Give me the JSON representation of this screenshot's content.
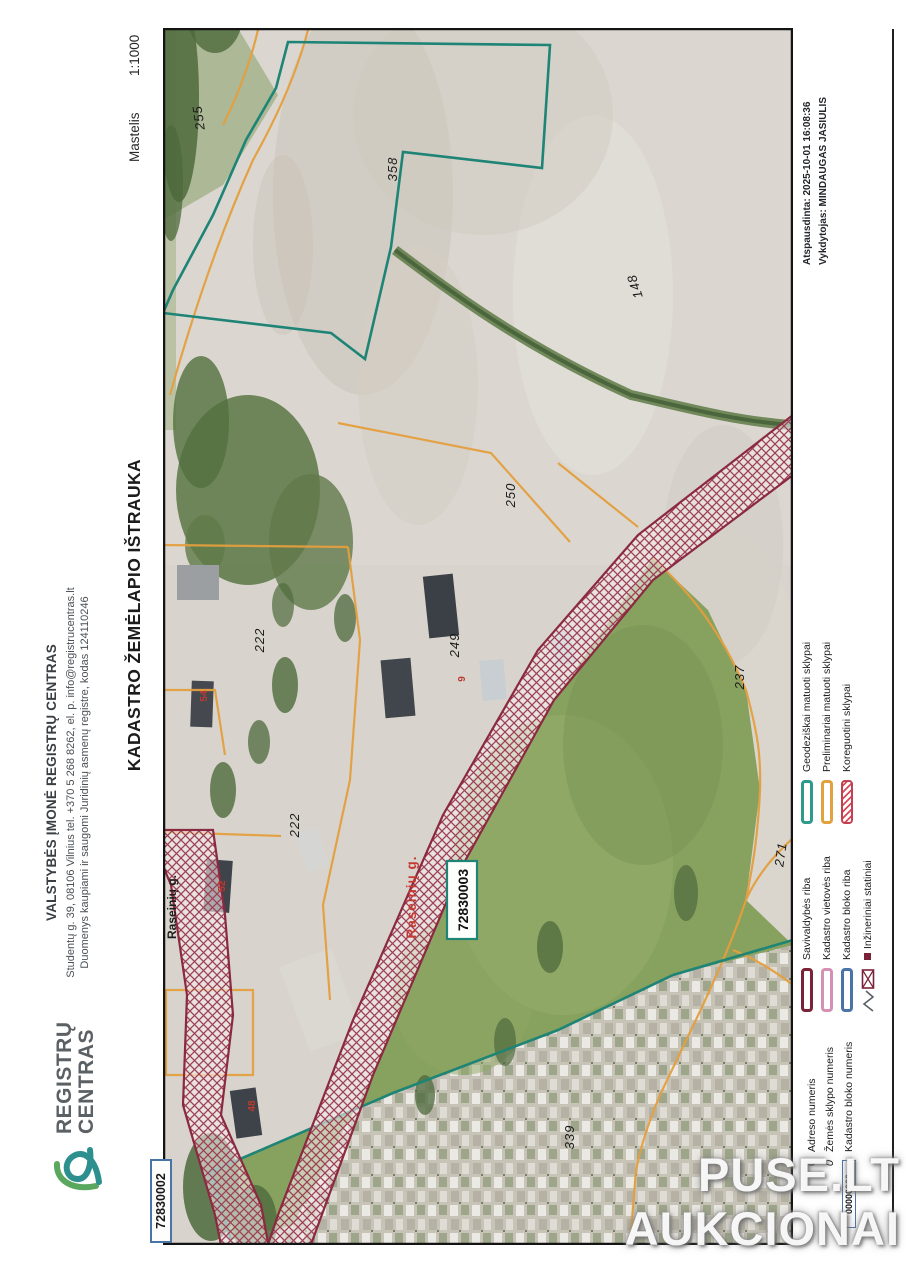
{
  "logo": {
    "line1": "REGISTRŲ",
    "line2": "CENTRAS"
  },
  "company": {
    "name": "VALSTYBĖS ĮMONĖ REGISTRŲ CENTRAS",
    "address": "Studentų g. 39, 08106 Vilnius tel. +370 5 268 8262,  el. p. info@registrucentras.lt",
    "registry_note": "Duomenys kaupiami ir saugomi Juridinių asmenų registre, kodas 124110246"
  },
  "title": "KADASTRO ŽEMĖLAPIO IŠTRAUKA",
  "scale": {
    "label": "Mastelis",
    "value": "1:1000"
  },
  "print_info": {
    "printed": "Atspausdinta: 2025-10-01 16:08:36",
    "operator": "Vykdytojas: MINDAUGAS JASIULIS"
  },
  "legend": {
    "numbers": [
      {
        "sample": "0",
        "label": "Adreso numeris"
      },
      {
        "sample": "0",
        "label": "Žemės sklypo numeris"
      },
      {
        "sample": "00000000",
        "label": "Kadastro bloko numeris"
      }
    ],
    "boundaries": [
      {
        "label": "Savivaldybės riba",
        "color": "#7a2338"
      },
      {
        "label": "Kadastro vietovės riba",
        "color": "#d491b4"
      },
      {
        "label": "Kadastro bloko riba",
        "color": "#4a74a8"
      },
      {
        "label": "Inžineriniai statiniai",
        "color": "#7a2338"
      }
    ],
    "parcels": [
      {
        "label": "Geodeziškai matuoti sklypai",
        "color": "#2f9a8c"
      },
      {
        "label": "Preliminariai matuoti sklypai",
        "color": "#e2a23f"
      },
      {
        "label": "Koreguotini sklypai",
        "color": "#c24052"
      }
    ]
  },
  "map": {
    "blocks": {
      "current": "72830003",
      "neighbor": "72830002"
    },
    "street_black": "Raseinių g.",
    "street_red": "Raseinių g.",
    "parcels": [
      "255",
      "358",
      "148",
      "250",
      "249",
      "237",
      "222",
      "222",
      "271",
      "339"
    ],
    "addresses": [
      "52",
      "54",
      "48",
      "9"
    ],
    "colors": {
      "geodezic_boundary": "#1e8476",
      "preliminary_boundary": "#e49f3e",
      "corrected_hatch": "#8a2940"
    }
  },
  "watermark": {
    "line1": "PUSE.LT",
    "line2": "AUKCIONAI"
  }
}
